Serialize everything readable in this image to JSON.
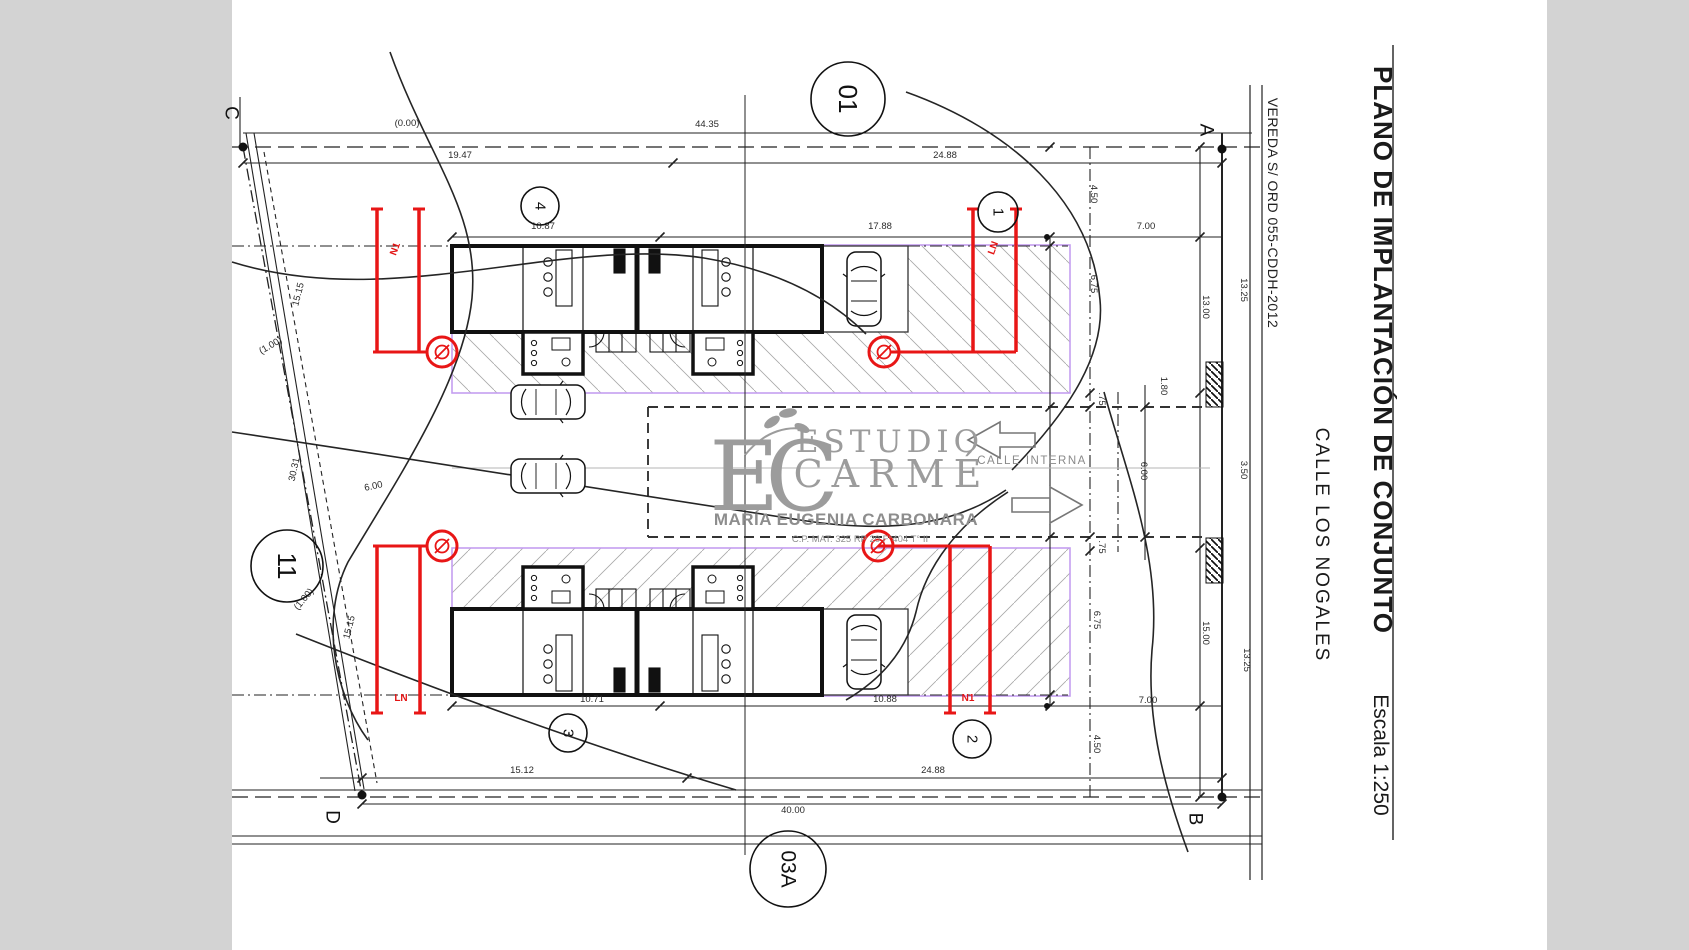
{
  "title_block": {
    "plan_title": "PLANO DE IMPLANTACIÓN DE CONJUNTO",
    "plan_scale": "Escala 1:250",
    "street_name": "CALLE LOS NOGALES",
    "sidewalk_note": "VEREDA S/ ORD 055-CDDH-2012"
  },
  "watermark": {
    "monogram": "EC",
    "studio_line1": "ESTUDIO",
    "studio_line2": "CARMÉ",
    "professional": "MARÍA EUGENIA CARBONARA",
    "registration": "C.P. MAT. 325 RP 20 F°404 T° II"
  },
  "street_labels": {
    "internal_street": "CALLE INTERNA"
  },
  "colors": {
    "line_black": "#1a1a1a",
    "buildable_zone_purple": "#c49ef0",
    "survey_red": "#e81616",
    "watermark_gray": "#9c9c9c",
    "margin_gray": "#d3d3d3"
  },
  "corner_letters": [
    {
      "label": "C",
      "x": 231,
      "y": 113
    },
    {
      "label": "A",
      "x": 1206,
      "y": 130
    },
    {
      "label": "D",
      "x": 332,
      "y": 817
    },
    {
      "label": "B",
      "x": 1195,
      "y": 819
    }
  ],
  "lot_markers": [
    {
      "label": "01",
      "x": 848,
      "y": 99,
      "r": 37,
      "fs": 26
    },
    {
      "label": "11",
      "x": 287,
      "y": 566,
      "r": 36,
      "fs": 26
    },
    {
      "label": "03A",
      "x": 788,
      "y": 869,
      "r": 38,
      "fs": 21
    },
    {
      "label": "1",
      "x": 998,
      "y": 212,
      "r": 20,
      "fs": 15
    },
    {
      "label": "2",
      "x": 972,
      "y": 739,
      "r": 19,
      "fs": 15
    },
    {
      "label": "3",
      "x": 568,
      "y": 733,
      "r": 19,
      "fs": 15
    },
    {
      "label": "4",
      "x": 540,
      "y": 206,
      "r": 19,
      "fs": 15
    }
  ],
  "red_labels": [
    {
      "t": "N1",
      "x": 398,
      "y": 250,
      "r": -70
    },
    {
      "t": "LN",
      "x": 996,
      "y": 249,
      "r": -70
    },
    {
      "t": "LN",
      "x": 401,
      "y": 701,
      "r": 0
    },
    {
      "t": "N1",
      "x": 968,
      "y": 701,
      "r": 0
    }
  ],
  "dimensions": [
    {
      "t": "(0.00)",
      "x": 407,
      "y": 126,
      "r": 0
    },
    {
      "t": "44.35",
      "x": 707,
      "y": 127,
      "r": 0
    },
    {
      "t": "19.47",
      "x": 460,
      "y": 158,
      "r": 0
    },
    {
      "t": "24.88",
      "x": 945,
      "y": 158,
      "r": 0
    },
    {
      "t": "10.87",
      "x": 543,
      "y": 229,
      "r": 0
    },
    {
      "t": "17.88",
      "x": 880,
      "y": 229,
      "r": 0
    },
    {
      "t": "7.00",
      "x": 1146,
      "y": 229,
      "r": 0
    },
    {
      "t": "4.50",
      "x": 1091,
      "y": 194,
      "r": 90
    },
    {
      "t": "6.75",
      "x": 1091,
      "y": 284,
      "r": 90
    },
    {
      "t": "13.00",
      "x": 1203,
      "y": 307,
      "r": 90
    },
    {
      "t": "13.25",
      "x": 1241,
      "y": 290,
      "r": 90
    },
    {
      "t": "1.80",
      "x": 1161,
      "y": 386,
      "r": 90
    },
    {
      "t": ".75",
      "x": 1099,
      "y": 399,
      "r": 90
    },
    {
      "t": "3.50",
      "x": 1241,
      "y": 470,
      "r": 90
    },
    {
      "t": "6.00",
      "x": 1141,
      "y": 471,
      "r": 90
    },
    {
      "t": ".75",
      "x": 1099,
      "y": 547,
      "r": 90
    },
    {
      "t": "6.75",
      "x": 1094,
      "y": 620,
      "r": 90
    },
    {
      "t": "15.00",
      "x": 1203,
      "y": 633,
      "r": 90
    },
    {
      "t": "13.25",
      "x": 1244,
      "y": 660,
      "r": 90
    },
    {
      "t": "7.00",
      "x": 1148,
      "y": 703,
      "r": 0
    },
    {
      "t": "4.50",
      "x": 1094,
      "y": 744,
      "r": 90
    },
    {
      "t": "10.71",
      "x": 592,
      "y": 702,
      "r": 0
    },
    {
      "t": "10.88",
      "x": 885,
      "y": 702,
      "r": 0
    },
    {
      "t": "15.12",
      "x": 522,
      "y": 773,
      "r": 0
    },
    {
      "t": "24.88",
      "x": 933,
      "y": 773,
      "r": 0
    },
    {
      "t": "40.00",
      "x": 793,
      "y": 813,
      "r": 0
    },
    {
      "t": "15.15",
      "x": 301,
      "y": 295,
      "r": -76
    },
    {
      "t": "(1.00)",
      "x": 272,
      "y": 348,
      "r": -30
    },
    {
      "t": "30.31",
      "x": 297,
      "y": 470,
      "r": -78
    },
    {
      "t": "6.00",
      "x": 374,
      "y": 489,
      "r": -12
    },
    {
      "t": "15.15",
      "x": 352,
      "y": 628,
      "r": -76
    },
    {
      "t": "(1.00)",
      "x": 306,
      "y": 601,
      "r": -50
    }
  ]
}
